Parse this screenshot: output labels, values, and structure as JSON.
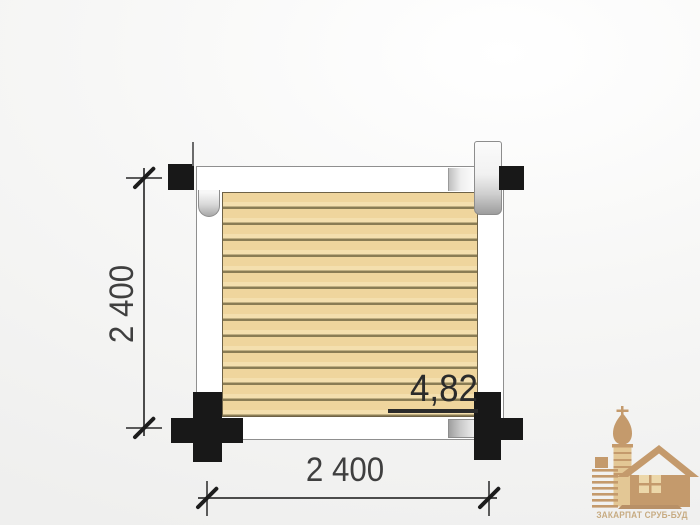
{
  "plan": {
    "bottom_dimension_label": "2 400",
    "left_dimension_label": "2 400",
    "area_label": "4,82"
  },
  "logo": {
    "company_name": "ЗАКАРПАТ СРУБ-БУД"
  },
  "colors": {
    "background": "#efefee",
    "beam_white": "#ffffff",
    "outline_gray": "#8f8f8f",
    "deck_fill": "#efd59d",
    "deck_line": "#8a7c54",
    "log_black": "#181818",
    "dim_color": "#3f3f3f",
    "area_color": "#2b2b2b",
    "logo_tan": "#c49a6c",
    "logo_tan_light": "#e3c795",
    "logo_window": "#ecd7a9",
    "logo_base": "#b89067",
    "logo_text": "#c7ab82"
  }
}
